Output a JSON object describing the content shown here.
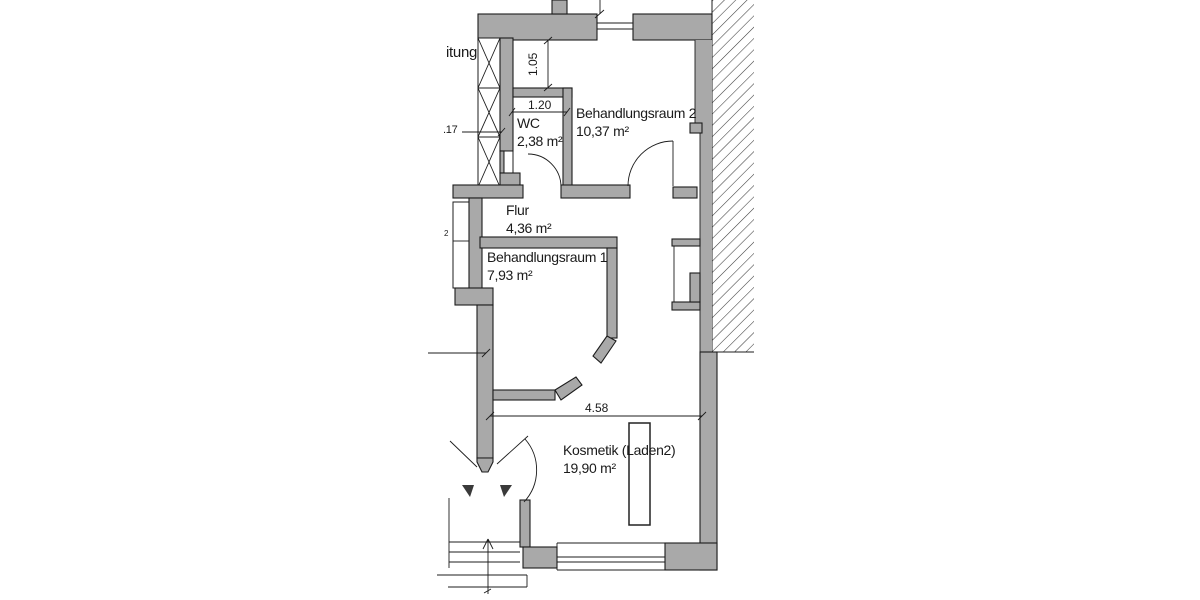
{
  "drawing": {
    "type": "architectural-floor-plan",
    "language": "de",
    "partial_left_label": "itung",
    "rooms": {
      "wc": {
        "name": "WC",
        "area": "2,38 m²"
      },
      "behandlungsraum2": {
        "name": "Behandlungsraum 2",
        "area": "10,37 m²"
      },
      "flur": {
        "name": "Flur",
        "area": "4,36 m²"
      },
      "behandlungsraum1": {
        "name": "Behandlungsraum 1",
        "area": "7,93 m²"
      },
      "kosmetik": {
        "name": "Kosmetik (Laden2)",
        "area": "19,90 m²"
      }
    },
    "dimensions": {
      "above_wc_height": "1.05",
      "wc_width": "1.20",
      "wall_thickness": ".17",
      "window_partial": "2",
      "kosmetik_width": "4.58"
    },
    "colors": {
      "wall_fill": "#a9a9a9",
      "line": "#1c1c1c",
      "background": "#ffffff"
    }
  }
}
